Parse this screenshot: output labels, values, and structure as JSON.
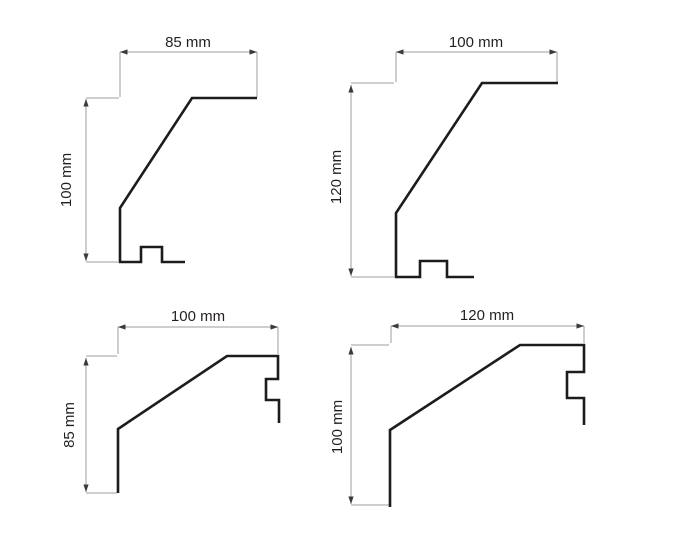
{
  "figure": {
    "type": "profile-dimension-drawings",
    "colors": {
      "background": "#ffffff",
      "profile_line": "#1c1c1c",
      "dimension_line": "#9d9d9d",
      "arrowhead": "#3a3a3a",
      "label_text": "#231f20"
    }
  },
  "diagrams": [
    {
      "position": "top-left",
      "width_label": "85 mm",
      "height_label": "100 mm",
      "width_mm": 85,
      "height_mm": 100
    },
    {
      "position": "top-right",
      "width_label": "100 mm",
      "height_label": "120 mm",
      "width_mm": 100,
      "height_mm": 120
    },
    {
      "position": "bottom-left",
      "width_label": "100 mm",
      "height_label": "85 mm",
      "width_mm": 100,
      "height_mm": 85
    },
    {
      "position": "bottom-right",
      "width_label": "120 mm",
      "height_label": "100 mm",
      "width_mm": 120,
      "height_mm": 100
    }
  ]
}
